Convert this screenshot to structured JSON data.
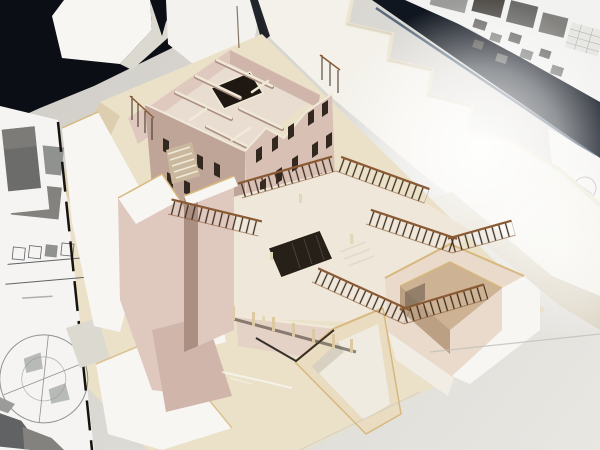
{
  "meta": {
    "type": "photograph",
    "subject": "cardboard architectural massing model on a white studio table",
    "view": "high-angle three-quarter view"
  },
  "palette": {
    "table_dark": "#cfccc6",
    "table_mid": "#dbd9d4",
    "table_light": "#e9e7e2",
    "backdrop_dark": "#0b0e14",
    "band_dark": "#10161f",
    "band_sheen": "#3a4d66",
    "poster_white": "#f2f2f1",
    "photo_g1": "#9b9b99",
    "photo_g2": "#6c6c6a",
    "photo_g3": "#524f4b",
    "photo_g4": "#84827e",
    "grid_gray": "#b5b5b2",
    "grid_bg": "#e7e7e4",
    "foam_white": "#f7f6f2",
    "foam_shadow": "#dcd9d1",
    "sheet_white": "#f4f2ee",
    "contour_face": "#f3f1ea",
    "contour_shadow": "#ded7c7",
    "contour_top": "#ece4d0",
    "base_cream": "#ebe1c8",
    "base_cream_dark": "#dcceae",
    "paper_white": "#f5f4f2",
    "drawing_gray": "#90928f",
    "drawing_dark": "#606264",
    "gap_dark": "#16130f",
    "pink_light": "#dfc9be",
    "pink_face": "#d8c0b4",
    "pink_mid": "#d0b6aa",
    "pink_dark": "#bfa498",
    "pink_deep": "#ab8f83",
    "cream_wall": "#f1e9d8",
    "cream_edge": "#d7b87e",
    "floor_light": "#e9ddd2",
    "floor_pale": "#efe7da",
    "window_dark": "#33281f",
    "window_deep": "#1f1711",
    "court_dark": "#262019",
    "rail_brown": "#8a5a34",
    "rail_dark": "#3c2c1f",
    "post_beige": "#dcc9a2",
    "box_tan": "#cdb294",
    "box_tan_dark": "#bca083",
    "fig_beige": "#e4d6b8",
    "fascia_pink": "#e5d2c7",
    "tray_wall": "#e9dcc0",
    "tray_floor": "#f0ebe1",
    "court_wall": "#e9dacb",
    "scratch_white": "#fafaf7",
    "seam_gray": "#c2bfb8"
  },
  "scene": {
    "background": {
      "table": "white studio table with faint seams and scratches",
      "backdrop": "dark navy presentation board running diagonally behind the table",
      "poster": "white presentation sheets with grayscale photos, thumbnail diagrams and a data grid",
      "contour_board": "white stepped site-contour cardboard"
    },
    "model": {
      "material": "cream and pink cardboard",
      "elements": [
        "main building with open roof and interior partition walls",
        "dark central courtyard opening",
        "gabled street facades with punched window openings",
        "stair tower and angular retaining wedges",
        "stepped terraces with stick balustrade railings",
        "sunken courtyard with tan-lined walls",
        "trapezoidal entry ramp tray",
        "colonnade posts",
        "tiny scale figures"
      ]
    },
    "left_papers": {
      "content": [
        "grayscale site photographs",
        "building elevation strip drawings",
        "circular site diagram",
        "dark massing plan fragments"
      ]
    }
  }
}
